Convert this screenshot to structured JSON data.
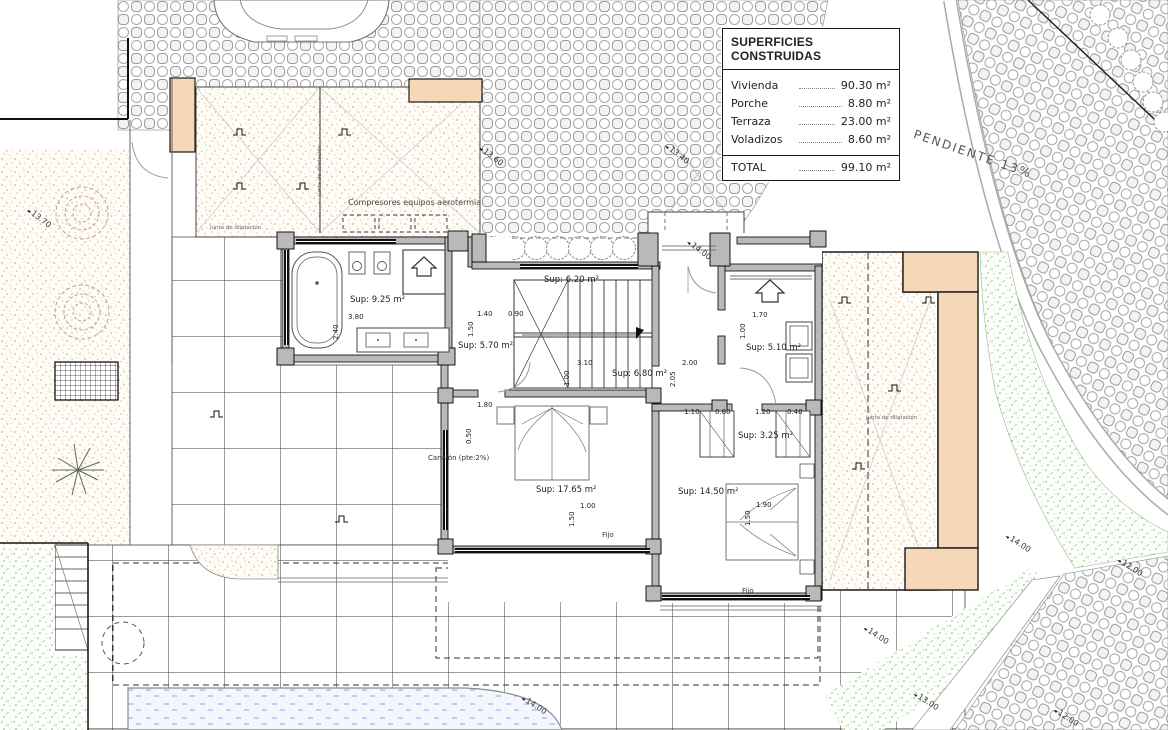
{
  "legend": {
    "title": "SUPERFICIES CONSTRUIDAS",
    "rows": [
      {
        "label": "Vivienda",
        "value": "90.30 m²"
      },
      {
        "label": "Porche",
        "value": "8.80 m²"
      },
      {
        "label": "Terraza",
        "value": "23.00 m²"
      },
      {
        "label": "Voladizos",
        "value": "8.60 m²"
      }
    ],
    "total_label": "TOTAL",
    "total_value": "99.10 m²"
  },
  "site_labels": {
    "pendiente": "PENDIENTE 13%",
    "compresores": "Compresores equipos aerotermia",
    "canalon": "Canalón (pte:2%)",
    "junta_1": "junta de dilatación",
    "junta_2": "junta de dilatación",
    "junta_3": "junta de dilatación"
  },
  "rooms": {
    "bath": "Sup: 9.25 m²",
    "hall": "Sup: 5.70 m²",
    "stairs": "Sup: 6.20 m²",
    "corridor": "Sup: 6.80 m²",
    "entry": "Sup: 5.10 m²",
    "closet": "Sup: 3.25 m²",
    "bedroom1": "Sup: 17.65 m²",
    "bedroom2": "Sup: 14.50 m²"
  },
  "window_labels": {
    "fijo_1": "Fijo",
    "fijo_2": "Fijo"
  },
  "site_dims": [
    {
      "v": "13.70"
    },
    {
      "v": "13.60"
    },
    {
      "v": "13.40"
    },
    {
      "v": "14.00"
    },
    {
      "v": "14.00"
    },
    {
      "v": "14.00"
    },
    {
      "v": "14.00"
    },
    {
      "v": "13.00"
    },
    {
      "v": "12.00"
    },
    {
      "v": "12.00"
    }
  ],
  "detail_dims": [
    {
      "v": "3.80"
    },
    {
      "v": "2.40"
    },
    {
      "v": "1.40"
    },
    {
      "v": "0.90"
    },
    {
      "v": "1.50"
    },
    {
      "v": "1.80"
    },
    {
      "v": "0.50"
    },
    {
      "v": "3.10"
    },
    {
      "v": "1.00"
    },
    {
      "v": "2.00"
    },
    {
      "v": "2.05"
    },
    {
      "v": "1.70"
    },
    {
      "v": "1.00"
    },
    {
      "v": "1.10"
    },
    {
      "v": "0.60"
    },
    {
      "v": "1.20"
    },
    {
      "v": "0.40"
    },
    {
      "v": "1.00"
    },
    {
      "v": "1.50"
    },
    {
      "v": "1.90"
    },
    {
      "v": "1.50"
    }
  ],
  "colors": {
    "wall_gray": "#b9b9b9",
    "peach_wall": "#f6d7b8",
    "sand_dot": "#cf9a62",
    "grass_green": "#7db45e",
    "water_blue": "#8ea3d4",
    "line_black": "#1a1a1a"
  }
}
